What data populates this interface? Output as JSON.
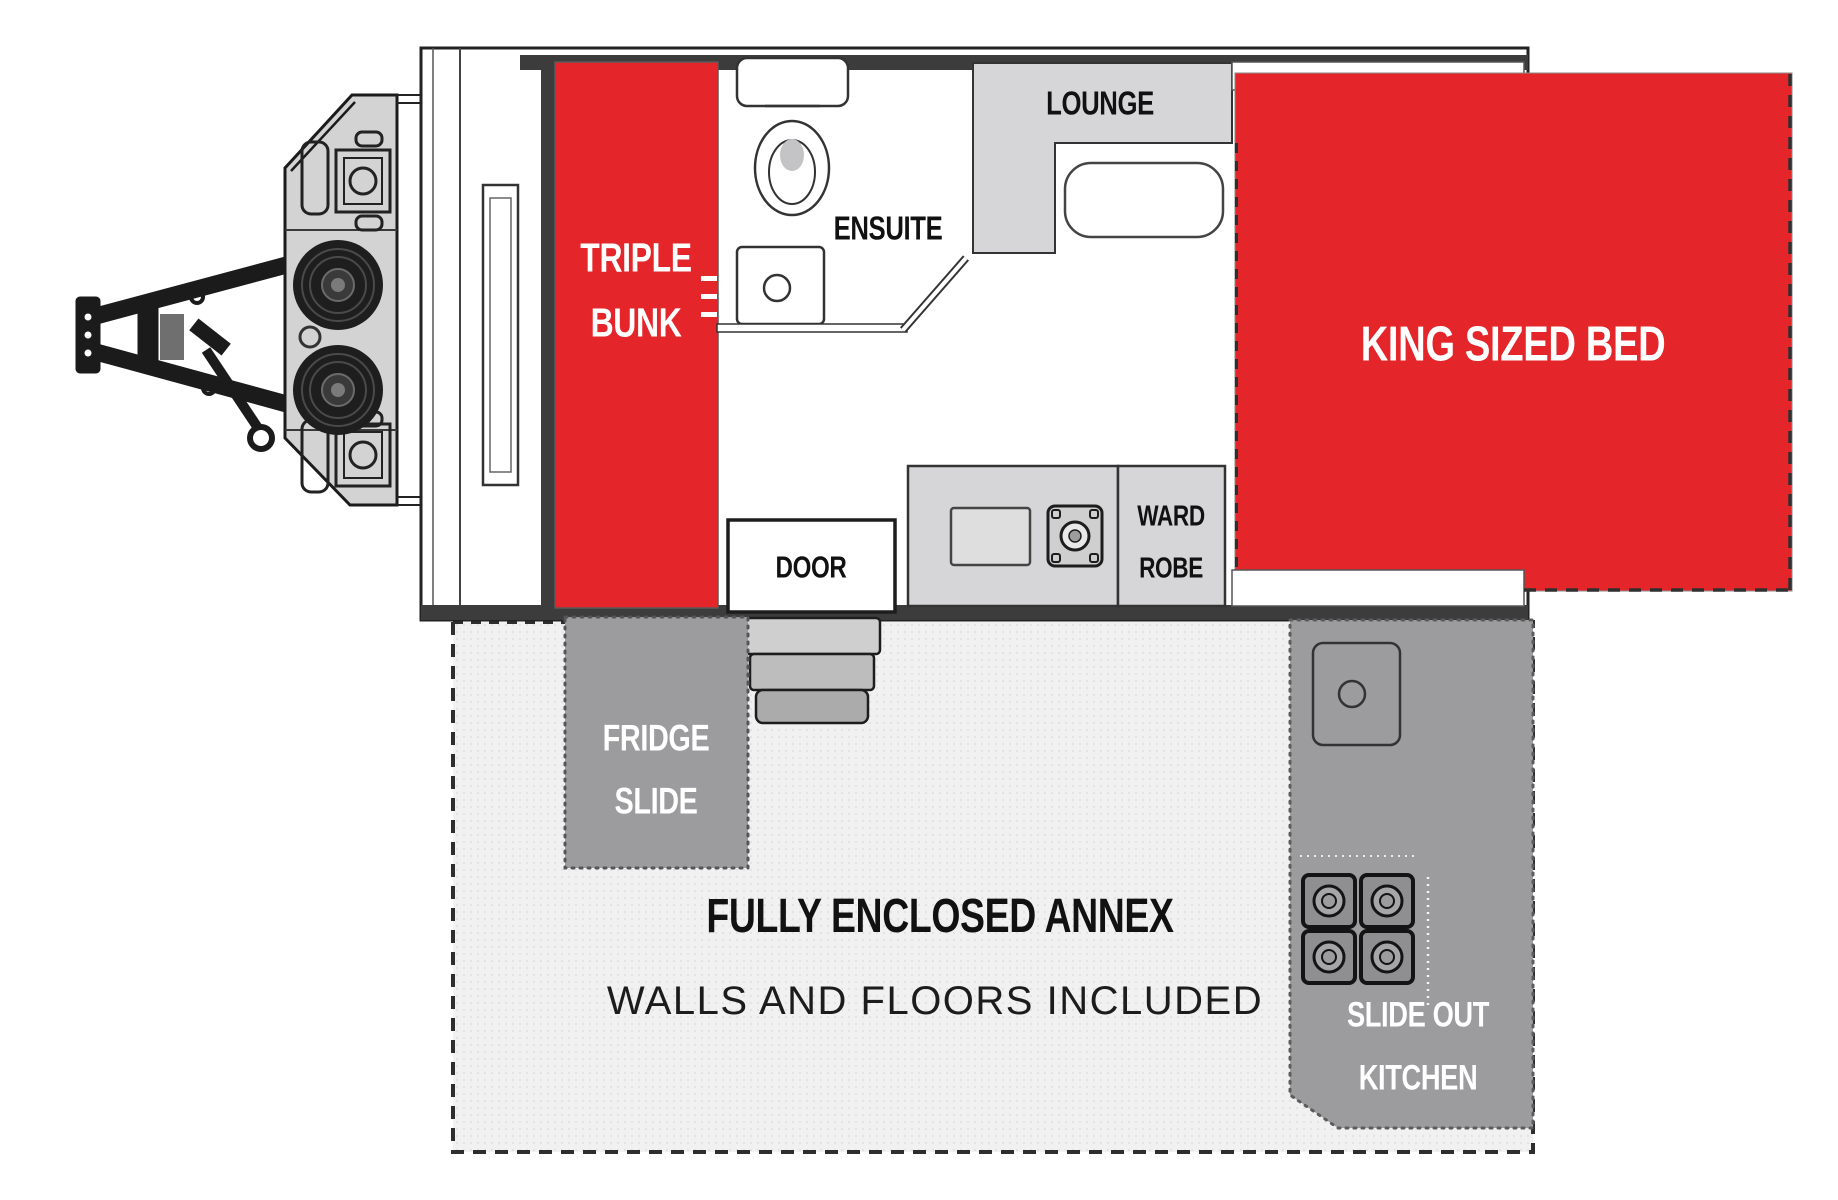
{
  "title": "Caravan floor plan with triple bunk, ensuite, lounge and king sized bed",
  "colors": {
    "highlight_red": "#e4252a",
    "furniture_gray": "#d6d6d8",
    "slide_dark_gray": "#9c9c9e",
    "annex_light_gray": "#f1f1f2",
    "wall_dark": "#3c3c3c"
  },
  "rooms": {
    "triple_bunk": {
      "line1": "TRIPLE",
      "line2": "BUNK"
    },
    "ensuite": {
      "label": "ENSUITE"
    },
    "lounge": {
      "label": "LOUNGE"
    },
    "king_bed": {
      "label": "KING SIZED BED"
    },
    "door": {
      "label": "DOOR"
    },
    "wardrobe": {
      "line1": "WARD",
      "line2": "ROBE"
    },
    "fridge_slide": {
      "line1": "FRIDGE",
      "line2": "SLIDE"
    },
    "slide_out_kitchen": {
      "line1": "SLIDE OUT",
      "line2": "KITCHEN"
    },
    "annex": {
      "line1": "FULLY ENCLOSED ANNEX",
      "line2": "WALLS AND FLOORS INCLUDED"
    }
  }
}
